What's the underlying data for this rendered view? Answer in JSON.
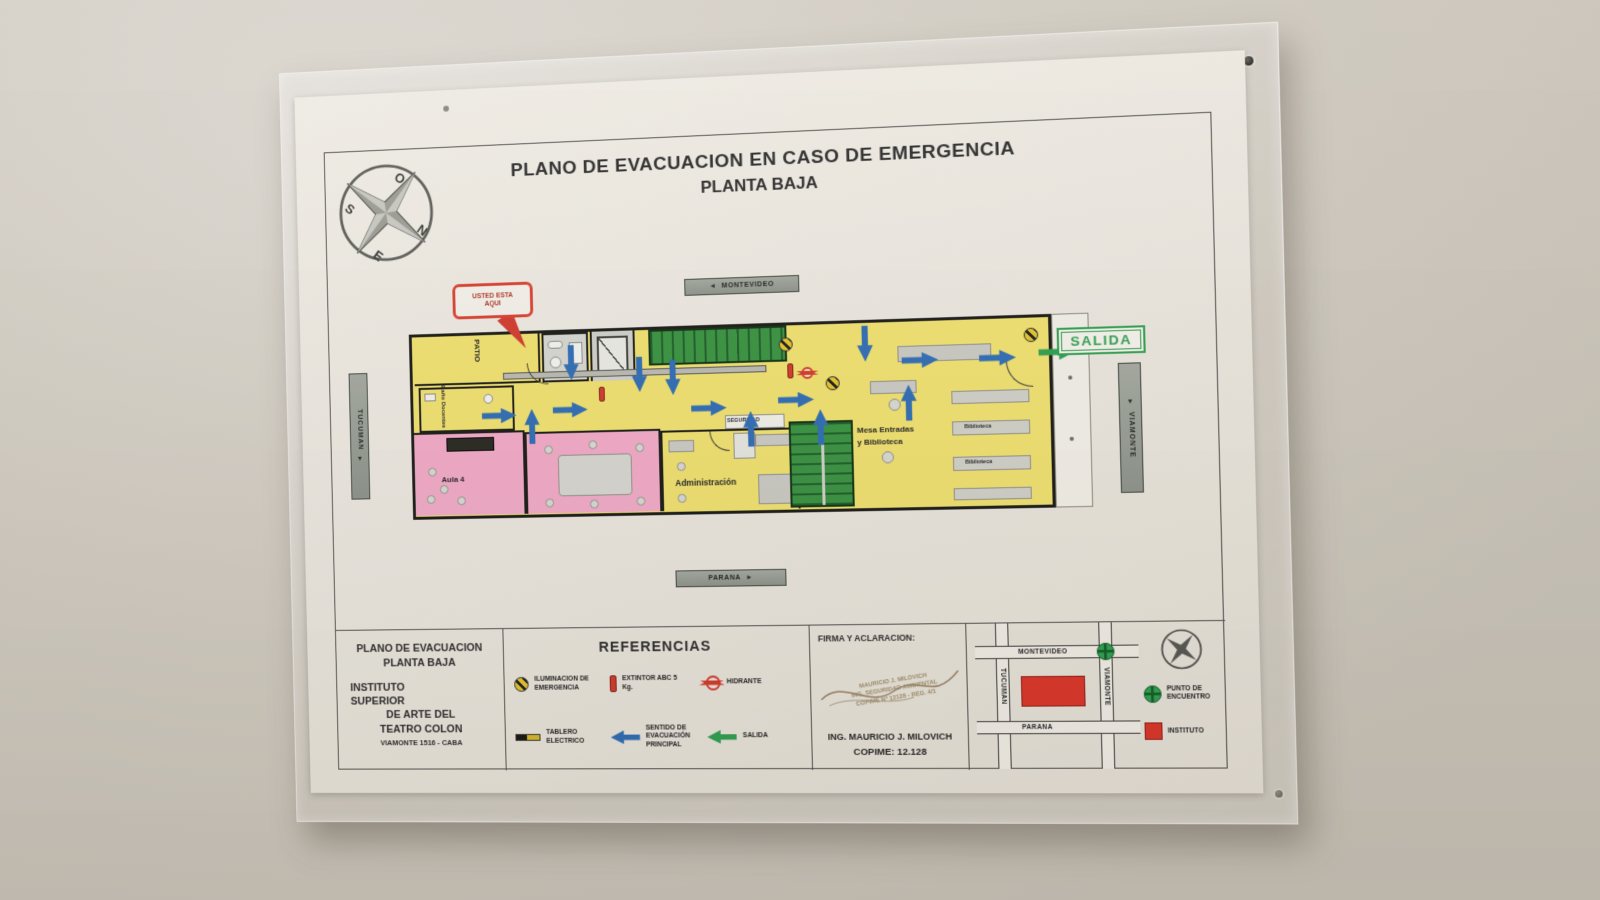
{
  "title": {
    "line1": "PLANO DE EVACUACION EN CASO DE EMERGENCIA",
    "line2": "PLANTA BAJA"
  },
  "compass": {
    "n": "N",
    "s": "S",
    "e": "E",
    "o": "O"
  },
  "streets": {
    "top": "MONTEVIDEO",
    "bottom": "PARANA",
    "left": "TUCUMAN",
    "right": "VIAMONTE"
  },
  "icons": {
    "street_arrow_left": "◄",
    "street_arrow_right": "►",
    "street_arrow_down": "▼"
  },
  "you_are_here": {
    "line1": "USTED ESTA",
    "line2": "AQUI"
  },
  "rooms": {
    "patio": "PATIO",
    "banio_docentes": "Baño Docentes",
    "aula4": "Aula 4",
    "seguridad": "SEGURIDAD",
    "administracion": "Administración",
    "mesa_line1": "Mesa Entradas",
    "mesa_line2": "y Biblioteca",
    "biblioteca1": "Biblioteca",
    "biblioteca2": "Biblioteca",
    "salida": "SALIDA"
  },
  "floor_plan": {
    "symbols": [
      {
        "type": "arrow",
        "dir": "right",
        "x": 72,
        "y": 74
      },
      {
        "type": "arrow",
        "dir": "right",
        "x": 146,
        "y": 70
      },
      {
        "type": "arrow",
        "dir": "right",
        "x": 288,
        "y": 72
      },
      {
        "type": "arrow",
        "dir": "right",
        "x": 376,
        "y": 66
      },
      {
        "type": "arrow",
        "dir": "right",
        "x": 500,
        "y": 30
      },
      {
        "type": "arrow",
        "dir": "right",
        "x": 576,
        "y": 30
      },
      {
        "type": "arrow",
        "dir": "down",
        "x": 148,
        "y": 22
      },
      {
        "type": "arrow",
        "dir": "down",
        "x": 218,
        "y": 36
      },
      {
        "type": "arrow",
        "dir": "down",
        "x": 252,
        "y": 40
      },
      {
        "type": "arrow",
        "dir": "down",
        "x": 446,
        "y": 12
      },
      {
        "type": "arrow",
        "dir": "up",
        "x": 106,
        "y": 86
      },
      {
        "type": "arrow",
        "dir": "up",
        "x": 330,
        "y": 94
      },
      {
        "type": "arrow",
        "dir": "up",
        "x": 400,
        "y": 94
      },
      {
        "type": "arrow",
        "dir": "up",
        "x": 488,
        "y": 72
      },
      {
        "type": "arrow",
        "dir": "right",
        "x": 634,
        "y": 26,
        "color": "green"
      },
      {
        "type": "emlight",
        "x": 378,
        "y": 12
      },
      {
        "type": "emlight",
        "x": 424,
        "y": 52
      },
      {
        "type": "emlight",
        "x": 620,
        "y": 10
      },
      {
        "type": "extintor",
        "x": 194,
        "y": 56
      },
      {
        "type": "extintor",
        "x": 386,
        "y": 38
      },
      {
        "type": "hydrant",
        "x": 400,
        "y": 42
      }
    ]
  },
  "info_block": {
    "title_line1": "PLANO DE EVACUACION",
    "title_line2": "PLANTA BAJA",
    "org_line1": "INSTITUTO",
    "org_line2": "SUPERIOR",
    "org_line3": "DE ARTE DEL",
    "org_line4": "TEATRO COLON",
    "address": "VIAMONTE 1516 - CABA"
  },
  "references": {
    "title": "REFERENCIAS",
    "items": [
      {
        "icon": "emergency-light",
        "label": "ILUMINACION DE EMERGENCIA"
      },
      {
        "icon": "extinguisher",
        "label": "EXTINTOR ABC 5 Kg."
      },
      {
        "icon": "hydrant",
        "label": "HIDRANTE"
      },
      {
        "icon": "electric-panel",
        "label": "TABLERO ELECTRICO"
      },
      {
        "icon": "blue-arrow",
        "label": "SENTIDO DE EVACUACIÓN PRINCIPAL"
      },
      {
        "icon": "green-arrow",
        "label": "SALIDA"
      }
    ]
  },
  "signature": {
    "title": "FIRMA Y ACLARACION:",
    "stamp_line1": "MAURICIO J. MILOVICH",
    "stamp_line2": "ING. SEGURIDAD AMBIENTAL",
    "stamp_line3": "COPIME Nº 12128 - REG. 4/1",
    "name": "ING. MAURICIO J. MILOVICH",
    "license": "COPIME: 12.128"
  },
  "mini_map": {
    "streets": {
      "top": "MONTEVIDEO",
      "bottom": "PARANA",
      "left": "TUCUMAN",
      "right": "VIAMONTE"
    },
    "legend": [
      {
        "icon": "meeting-point",
        "label_line1": "PUNTO DE",
        "label_line2": "ENCUENTRO"
      },
      {
        "icon": "institute",
        "label_line1": "INSTITUTO",
        "label_line2": ""
      }
    ]
  },
  "colors": {
    "plan_yellow": "#efe06e",
    "classroom_pink": "#f2a9c6",
    "stair_green": "#2f8a3d",
    "evacuation_blue": "#2e6cb3",
    "alert_red": "#d0392b",
    "exit_green": "#2e9e4f",
    "wall": "#cdc7bd",
    "paper": "#ece8e0"
  }
}
